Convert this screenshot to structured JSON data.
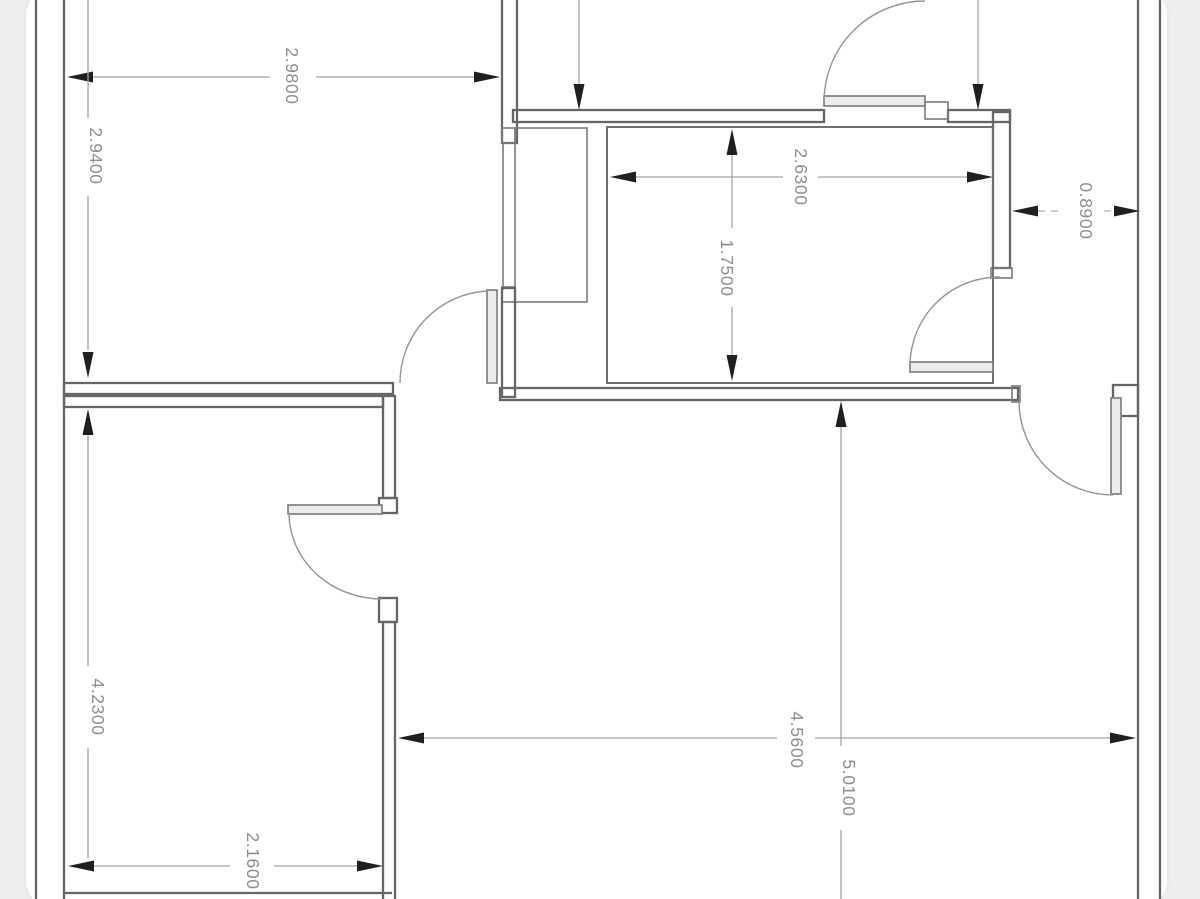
{
  "drawing": {
    "kind": "floor-plan"
  },
  "colors": {
    "paper": "#ffffff",
    "margin": "#eeeeef",
    "wall_line": "#666666",
    "dimension_line": "#a3a3a3",
    "dimension_text": "#8d8d8d",
    "arrowhead": "#1f1f1f"
  },
  "dimensions": [
    {
      "name": "top-left-room-width",
      "label": "2.9800"
    },
    {
      "name": "top-left-room-height",
      "label": "2.9400"
    },
    {
      "name": "bathroom-width",
      "label": "2.6300"
    },
    {
      "name": "bathroom-height",
      "label": "1.7500"
    },
    {
      "name": "right-corridor-width",
      "label": "0.8900"
    },
    {
      "name": "lower-left-room-height",
      "label": "4.2300"
    },
    {
      "name": "lower-left-room-width",
      "label": "2.1600"
    },
    {
      "name": "lower-right-room-width",
      "label": "4.5600"
    },
    {
      "name": "lower-right-room-height",
      "label": "5.0100"
    }
  ]
}
